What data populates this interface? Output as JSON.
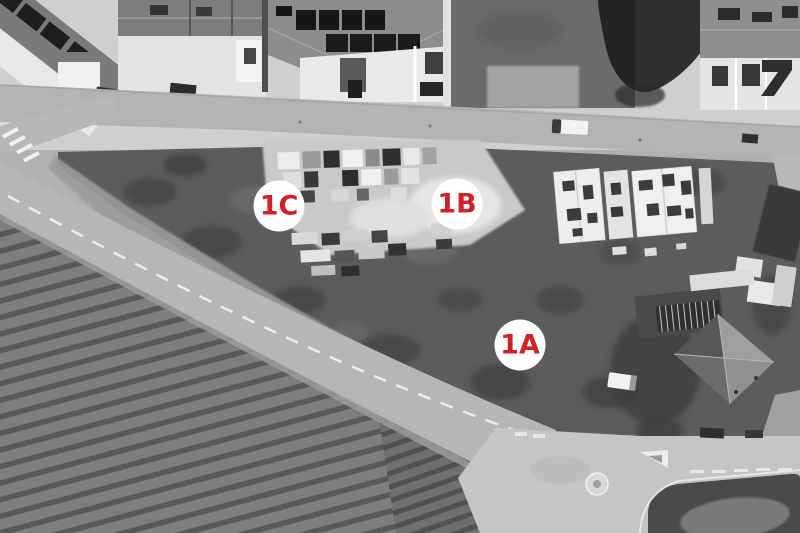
{
  "figure": {
    "description": "Black-and-white aerial photograph of a development site with roads, a striped vineyard field, a storage yard, buildings under construction and a villa, annotated with three numbered site markers",
    "marker_text_color": "#cf2127",
    "marker_bg_color": "#ffffff"
  },
  "markers": [
    {
      "label": "1C",
      "x": 279,
      "y": 206
    },
    {
      "label": "1B",
      "x": 457,
      "y": 204
    },
    {
      "label": "1A",
      "x": 520,
      "y": 345
    }
  ]
}
